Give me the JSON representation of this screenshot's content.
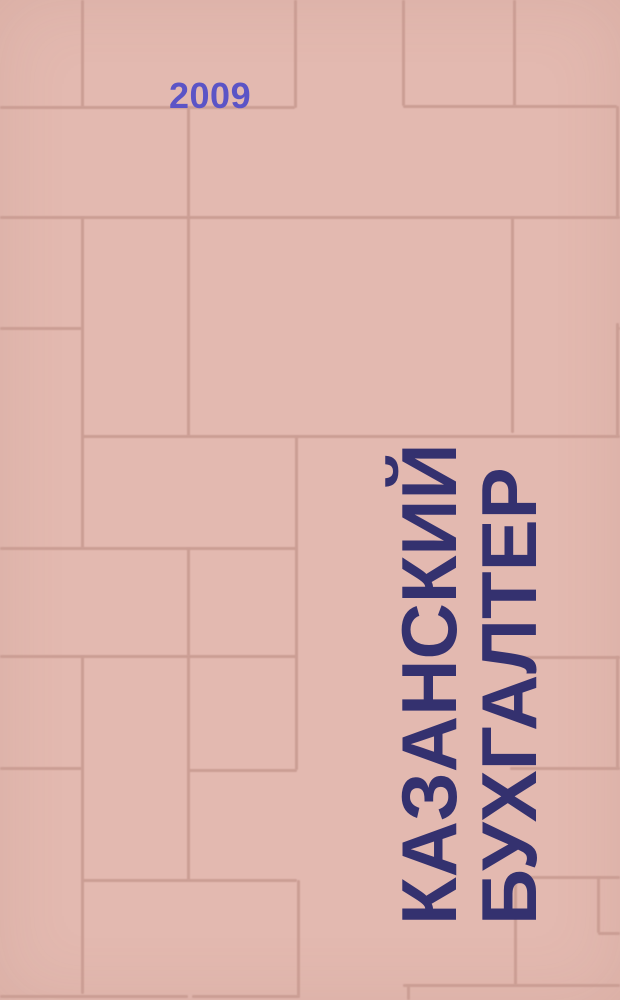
{
  "cover": {
    "year": "2009",
    "title_line1": "КАЗАНСКИЙ",
    "title_line2": "БУХГАЛТЕР"
  },
  "colors": {
    "background": "#e3b9b0",
    "tile_line": "#cb9e94",
    "year_text": "#5b54c6",
    "title_text": "#34316f"
  },
  "pattern": {
    "h_segments": [
      [
        107,
        0,
        295
      ],
      [
        106,
        403,
        617
      ],
      [
        217,
        0,
        620
      ],
      [
        328,
        0,
        82
      ],
      [
        328,
        617,
        620
      ],
      [
        436,
        82,
        620
      ],
      [
        548,
        0,
        297
      ],
      [
        656,
        0,
        297
      ],
      [
        657,
        510,
        620
      ],
      [
        768,
        0,
        82
      ],
      [
        770,
        188,
        297
      ],
      [
        768,
        510,
        620
      ],
      [
        877,
        510,
        620
      ],
      [
        880,
        82,
        297
      ],
      [
        933,
        598,
        620
      ],
      [
        985,
        403,
        620
      ],
      [
        996,
        0,
        188
      ],
      [
        996,
        192,
        300
      ]
    ],
    "v_segments": [
      [
        82,
        0,
        107
      ],
      [
        295,
        0,
        108
      ],
      [
        403,
        0,
        106
      ],
      [
        514,
        0,
        106
      ],
      [
        617,
        106,
        217
      ],
      [
        188,
        107,
        217
      ],
      [
        82,
        217,
        548
      ],
      [
        188,
        217,
        436
      ],
      [
        512,
        217,
        433
      ],
      [
        617,
        323,
        436
      ],
      [
        296,
        436,
        770
      ],
      [
        188,
        548,
        656
      ],
      [
        82,
        656,
        994
      ],
      [
        188,
        656,
        880
      ],
      [
        617,
        656,
        768
      ],
      [
        598,
        877,
        933
      ],
      [
        515,
        877,
        985
      ],
      [
        298,
        880,
        996
      ],
      [
        408,
        985,
        1000
      ]
    ]
  }
}
